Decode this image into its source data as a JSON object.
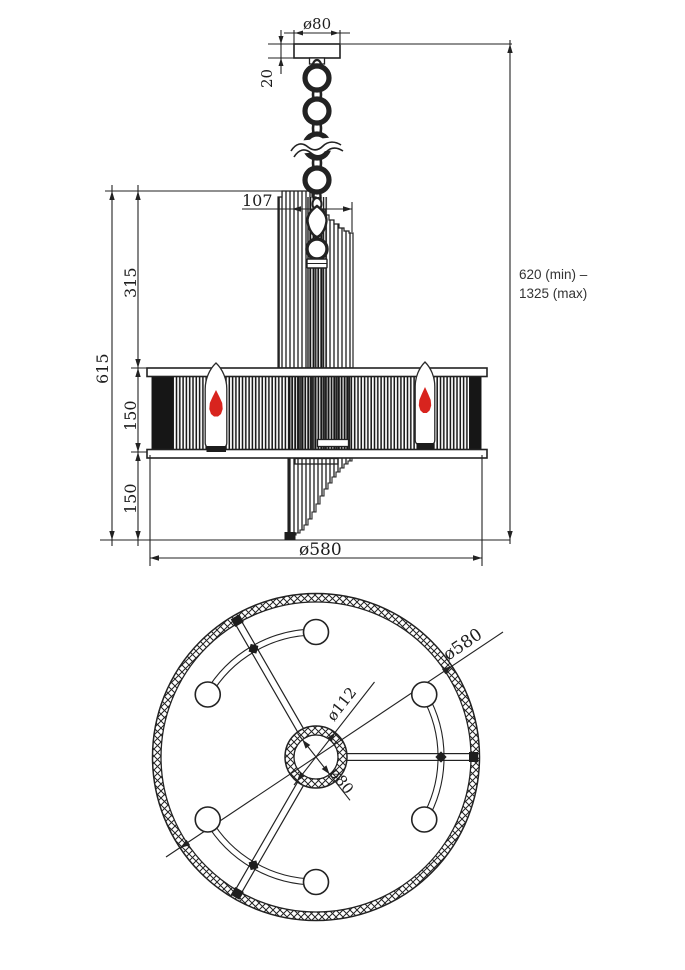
{
  "drawing": {
    "front": {
      "canopy_diameter": "ø80",
      "canopy_height": "20",
      "cluster_width": "107",
      "overall_body_height": "615",
      "upper_section_height": "315",
      "shade_height": "150",
      "lower_section_height": "150",
      "shade_diameter": "ø580",
      "hanging_height_line1": "620 (min) –",
      "hanging_height_line2": "1325 (max)"
    },
    "plan": {
      "outer_diameter": "ø580",
      "hub_outer_diameter": "ø112",
      "hub_inner_diameter": "ø80"
    },
    "colors": {
      "line": "#222222",
      "flame": "#d8241e"
    }
  }
}
